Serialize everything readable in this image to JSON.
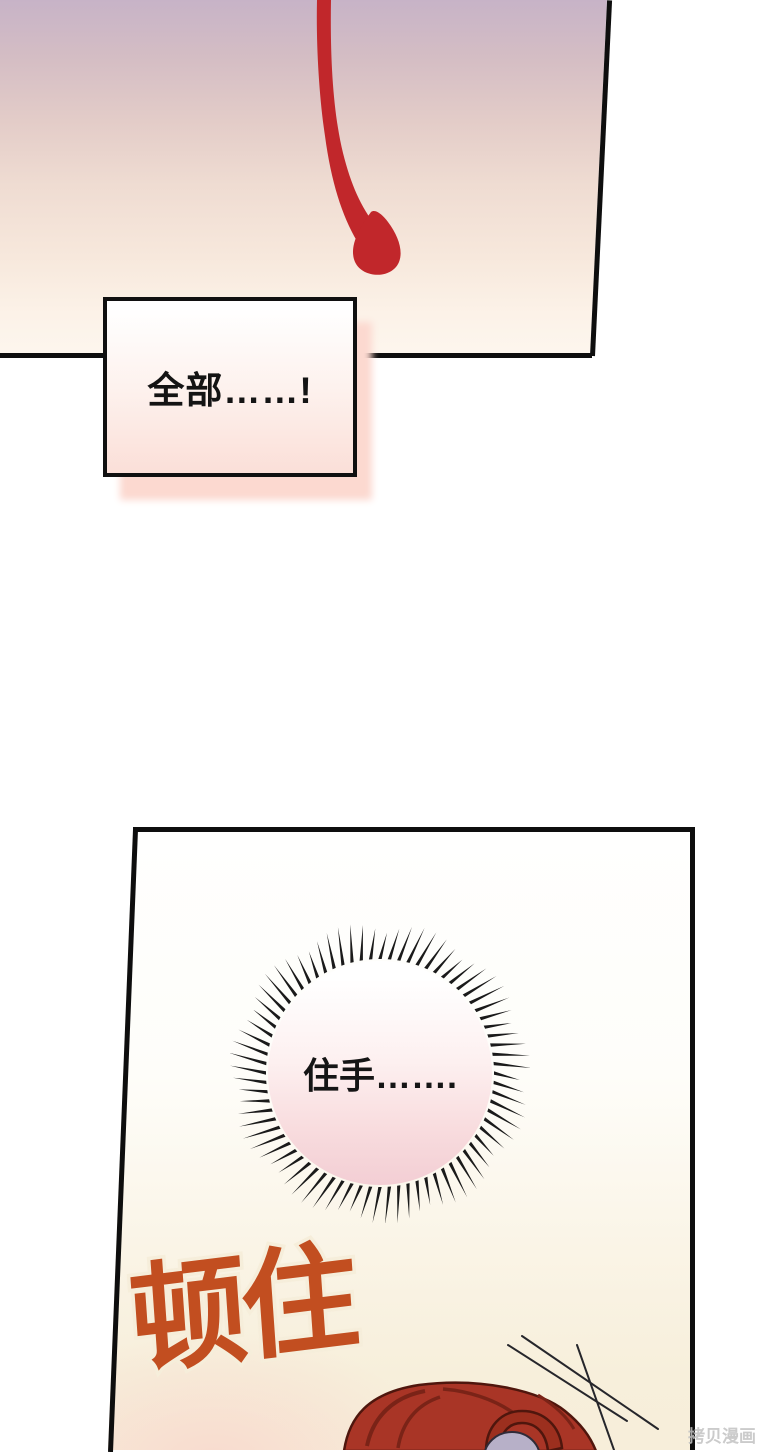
{
  "page": {
    "kind": "manhwa-comic-page",
    "background_color": "#ffffff"
  },
  "panels": {
    "top": {
      "description": "gradient sky panel with dripping blood streak",
      "gradient_top": "#c7b3c7",
      "gradient_bottom": "#fdf6ee",
      "blood_color": "#c1272b",
      "border_color": "#0e0e0e",
      "speech_text": "全部……!",
      "speech_box_shadow_color": "#fcd9d0"
    },
    "bottom": {
      "description": "panel with spiky scream bubble, orange sound effect and red-haired character",
      "background_color": "#f7eeda",
      "border_color": "#0e0e0e",
      "scream_text": "住手…….",
      "burst_fill_top": "#ffffff",
      "burst_fill_bottom": "#f3ced4",
      "spike_color": "#1a1a1a",
      "sfx_text": "顿住",
      "sfx_color": "#c24e20",
      "hair_color": "#a93526",
      "hair_shadow_color": "#7a2317",
      "face_color": "#b7b0c8",
      "speedline_color": "#26262b"
    }
  },
  "watermark": {
    "text": "拷贝漫画",
    "color": "#c3c3c3"
  }
}
